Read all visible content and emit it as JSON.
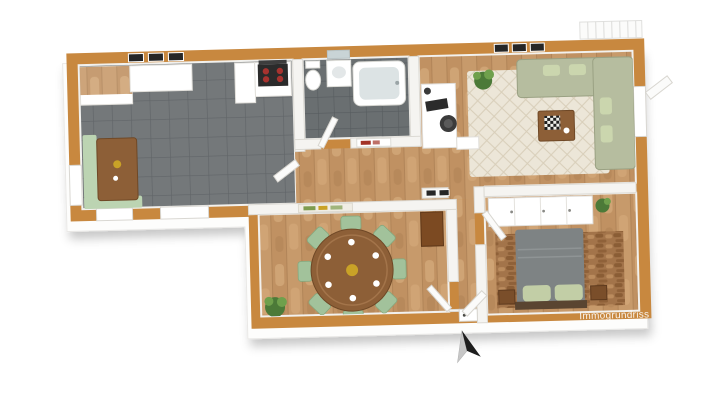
{
  "watermark": "Immogrundriss",
  "scene": {
    "type": "3d-floorplan-render",
    "rooms": [
      {
        "name": "kitchen-living",
        "floor": "gray-tile",
        "furniture": [
          "upper-cabinets",
          "wood-top-counter",
          "tall-cabinet",
          "stove-with-hood",
          "corner-bench",
          "wood-table",
          "wall-frames"
        ]
      },
      {
        "name": "bathroom",
        "floor": "gray-tile",
        "furniture": [
          "toilet",
          "vanity-sink",
          "mirror",
          "bathtub",
          "door"
        ]
      },
      {
        "name": "living-room",
        "floor": "wood",
        "furniture": [
          "desk",
          "monitor",
          "desk-chair",
          "area-rug",
          "corner-sofa",
          "coffee-table",
          "plant",
          "balcony-door",
          "balcony-railing"
        ]
      },
      {
        "name": "hallway",
        "floor": "wood",
        "furniture": [
          "wall-art",
          "picture-frames"
        ]
      },
      {
        "name": "dining-room",
        "floor": "wood",
        "furniture": [
          "round-table",
          "eight-chairs",
          "plant",
          "cabinet",
          "wall-art",
          "door"
        ]
      },
      {
        "name": "bedroom",
        "floor": "wood",
        "furniture": [
          "wardrobe",
          "double-bed",
          "pillows",
          "nightstands",
          "bed-rug",
          "plant",
          "door"
        ]
      },
      {
        "name": "entry-corridor",
        "floor": "wood",
        "furniture": [
          "entrance-door"
        ]
      }
    ],
    "compass": "north-arrow-bottom-center"
  },
  "colors": {
    "wall": "#C8883F",
    "iwall": "#F5F4F1",
    "iwallEdge": "#DCDAD4",
    "white": "#FFFFFF",
    "tile": "#74787A",
    "grout": "#616568",
    "bathTile": "#6A6F71",
    "bathGrout": "#575C5F",
    "wood": "#C79A6B",
    "woodAlt": "#B98B5B",
    "woodLight": "#DEB887",
    "woodSeam": "#9C7148",
    "rug": "#ECE6D8",
    "rugLine": "#D8CEB9",
    "sofa": "#B6BD9F",
    "sofaEdge": "#9AA183",
    "pillow": "#CBD6AE",
    "chair": "#A2C29B",
    "chairEdge": "#85A87E",
    "tableWood": "#8D5F37",
    "tableEdge": "#6F4826",
    "bench": "#BCD4B2",
    "duvet": "#7E8384",
    "duvetFold": "#8F9495",
    "bedPillow": "#C2CEA6",
    "headboard": "#5A4531",
    "bedRug": "#A3744A",
    "bedRugDark": "#8A5D35",
    "bedRugLight": "#BB8C5E",
    "nightstand": "#7A4E2A",
    "cabinet": "#7C4A22",
    "appl": "#2B2B2B",
    "hood": "#3D3D3D",
    "burner": "#A8332F",
    "basin": "#E3E7E8",
    "mirror": "#C9D4D6",
    "tub": "#DCE3E4",
    "plant": "#4C7A38",
    "plantLight": "#6FA04C",
    "pot": "#3A3A3A",
    "frame": "#262626",
    "artRed": "#A33327",
    "artGreen": "#7E9C4F",
    "gold": "#C9A227",
    "door": "#FBFBFA",
    "doorEdge": "#D8D6D0",
    "arrowDark": "#1E1E1E",
    "arrowLight": "#C7C7C7",
    "watermarkColor": "#FFFFFF"
  }
}
